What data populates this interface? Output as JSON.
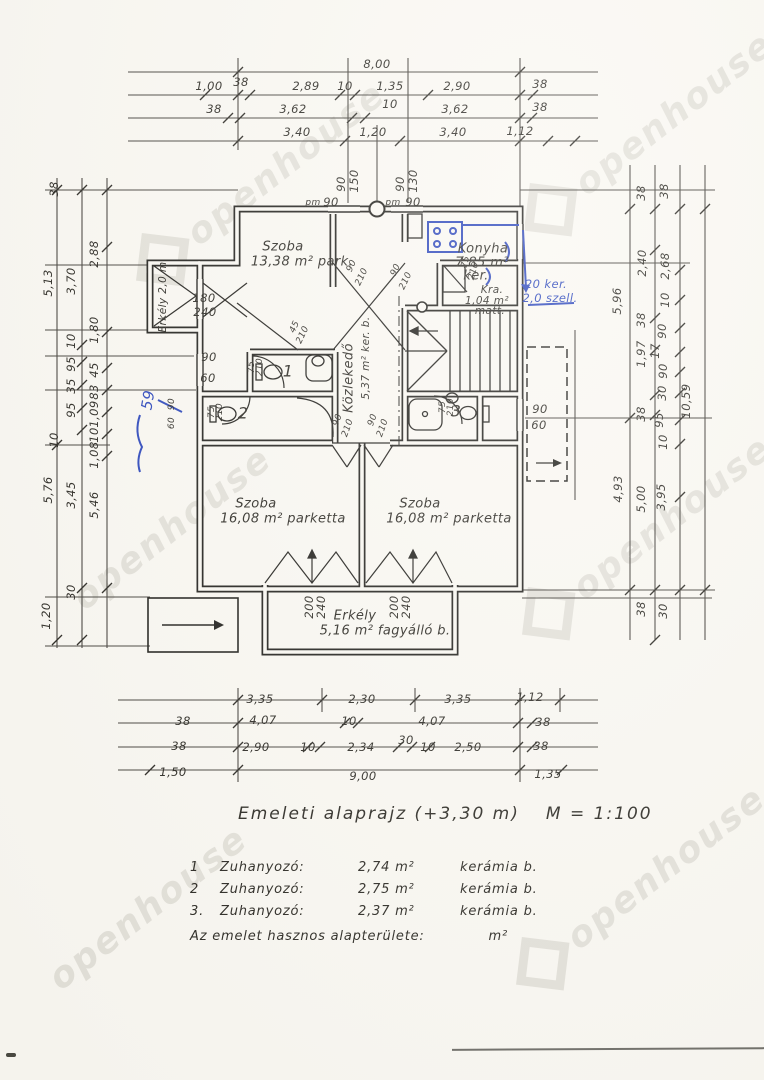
{
  "caption": {
    "text": "Emeleti alaprajz (+3,30 m)",
    "scale": "M = 1:100"
  },
  "notes": {
    "rows": [
      {
        "num": "1",
        "name": "Zuhanyozó:",
        "area": "2,74 m²",
        "finish": "kerámia b."
      },
      {
        "num": "2",
        "name": "Zuhanyozó:",
        "area": "2,75 m²",
        "finish": "kerámia b."
      },
      {
        "num": "3.",
        "name": "Zuhanyozó:",
        "area": "2,37 m²",
        "finish": "kerámia b."
      }
    ],
    "footer": {
      "text": "Az emelet hasznos alapterülete:",
      "unit": "m²"
    }
  },
  "watermark": {
    "text": "openhouse"
  },
  "colors": {
    "ink": "#2a2822",
    "blue_pen": "#2b46bb",
    "paper": "#faf8f2"
  },
  "labels": [
    {
      "t": "8,00",
      "x": 377,
      "y": 64
    },
    {
      "t": "1,00",
      "x": 209,
      "y": 86
    },
    {
      "t": "38",
      "x": 241,
      "y": 82
    },
    {
      "t": "2,89",
      "x": 306,
      "y": 86
    },
    {
      "t": "10",
      "x": 345,
      "y": 86
    },
    {
      "t": "1,35",
      "x": 390,
      "y": 86
    },
    {
      "t": "2,90",
      "x": 457,
      "y": 86
    },
    {
      "t": "38",
      "x": 540,
      "y": 84
    },
    {
      "t": "38",
      "x": 214,
      "y": 109
    },
    {
      "t": "3,62",
      "x": 293,
      "y": 109
    },
    {
      "t": "10",
      "x": 390,
      "y": 104
    },
    {
      "t": "3,62",
      "x": 455,
      "y": 109
    },
    {
      "t": "38",
      "x": 540,
      "y": 107
    },
    {
      "t": "3,40",
      "x": 297,
      "y": 132
    },
    {
      "t": "1,20",
      "x": 373,
      "y": 132
    },
    {
      "t": "3,40",
      "x": 453,
      "y": 132
    },
    {
      "t": "1,12",
      "x": 520,
      "y": 131
    },
    {
      "t": "90",
      "x": 341,
      "y": 184,
      "r": -90
    },
    {
      "t": "150",
      "x": 354,
      "y": 181,
      "r": -90
    },
    {
      "t": "90",
      "x": 400,
      "y": 184,
      "r": -90
    },
    {
      "t": "130",
      "x": 413,
      "y": 181,
      "r": -90
    },
    {
      "t": "pm",
      "x": 313,
      "y": 203,
      "s": 9
    },
    {
      "t": "90",
      "x": 331,
      "y": 202
    },
    {
      "t": "pm",
      "x": 393,
      "y": 203,
      "s": 9
    },
    {
      "t": "90",
      "x": 413,
      "y": 202
    },
    {
      "t": "38",
      "x": 54,
      "y": 189,
      "r": -90
    },
    {
      "t": "5,13",
      "x": 48,
      "y": 283,
      "r": -90
    },
    {
      "t": "3,70",
      "x": 71,
      "y": 281,
      "r": -90
    },
    {
      "t": "2,88",
      "x": 94,
      "y": 254,
      "r": -90
    },
    {
      "t": "1,80",
      "x": 94,
      "y": 330,
      "r": -90
    },
    {
      "t": "10",
      "x": 71,
      "y": 341,
      "r": -90
    },
    {
      "t": "95",
      "x": 71,
      "y": 364,
      "r": -90
    },
    {
      "t": "35",
      "x": 71,
      "y": 386,
      "r": -90
    },
    {
      "t": "95",
      "x": 71,
      "y": 410,
      "r": -90
    },
    {
      "t": "10",
      "x": 54,
      "y": 440,
      "r": -90
    },
    {
      "t": "45",
      "x": 94,
      "y": 370,
      "r": -90
    },
    {
      "t": "83",
      "x": 94,
      "y": 392,
      "r": -90
    },
    {
      "t": "1,09",
      "x": 94,
      "y": 414,
      "r": -90
    },
    {
      "t": "10",
      "x": 94,
      "y": 435,
      "r": -90
    },
    {
      "t": "1,08",
      "x": 94,
      "y": 455,
      "r": -90
    },
    {
      "t": "5,76",
      "x": 48,
      "y": 490,
      "r": -90
    },
    {
      "t": "3,45",
      "x": 71,
      "y": 495,
      "r": -90
    },
    {
      "t": "5,46",
      "x": 94,
      "y": 505,
      "r": -90
    },
    {
      "t": "30",
      "x": 71,
      "y": 592,
      "r": -90
    },
    {
      "t": "1,20",
      "x": 46,
      "y": 616,
      "r": -90
    },
    {
      "t": "38",
      "x": 641,
      "y": 193,
      "r": -90
    },
    {
      "t": "38",
      "x": 664,
      "y": 191,
      "r": -90
    },
    {
      "t": "2,40",
      "x": 642,
      "y": 263,
      "r": -90
    },
    {
      "t": "2,68",
      "x": 665,
      "y": 266,
      "r": -90
    },
    {
      "t": "10",
      "x": 665,
      "y": 300,
      "r": -90
    },
    {
      "t": "5,96",
      "x": 617,
      "y": 301,
      "r": -90
    },
    {
      "t": "38",
      "x": 641,
      "y": 320,
      "r": -90
    },
    {
      "t": "90",
      "x": 662,
      "y": 331,
      "r": -90
    },
    {
      "t": "1,97",
      "x": 641,
      "y": 354,
      "r": -90
    },
    {
      "t": "17",
      "x": 655,
      "y": 351,
      "r": -90
    },
    {
      "t": "90",
      "x": 663,
      "y": 371,
      "r": -90
    },
    {
      "t": "30",
      "x": 662,
      "y": 393,
      "r": -90
    },
    {
      "t": "10,59",
      "x": 686,
      "y": 401,
      "r": -90
    },
    {
      "t": "38",
      "x": 641,
      "y": 414,
      "r": -90
    },
    {
      "t": "95",
      "x": 659,
      "y": 420,
      "r": -90
    },
    {
      "t": "10",
      "x": 663,
      "y": 442,
      "r": -90
    },
    {
      "t": "4,93",
      "x": 618,
      "y": 489,
      "r": -90
    },
    {
      "t": "5,00",
      "x": 641,
      "y": 499,
      "r": -90
    },
    {
      "t": "3,95",
      "x": 661,
      "y": 497,
      "r": -90
    },
    {
      "t": "38",
      "x": 641,
      "y": 609,
      "r": -90
    },
    {
      "t": "30",
      "x": 663,
      "y": 611,
      "r": -90
    },
    {
      "t": "3,35",
      "x": 260,
      "y": 699
    },
    {
      "t": "2,30",
      "x": 362,
      "y": 699
    },
    {
      "t": "3,35",
      "x": 458,
      "y": 699
    },
    {
      "t": "1,12",
      "x": 530,
      "y": 697
    },
    {
      "t": "38",
      "x": 183,
      "y": 721
    },
    {
      "t": "4,07",
      "x": 263,
      "y": 720
    },
    {
      "t": "10",
      "x": 349,
      "y": 721
    },
    {
      "t": "4,07",
      "x": 432,
      "y": 721
    },
    {
      "t": "38",
      "x": 543,
      "y": 722
    },
    {
      "t": "38",
      "x": 179,
      "y": 746
    },
    {
      "t": "2,90",
      "x": 256,
      "y": 747
    },
    {
      "t": "10",
      "x": 308,
      "y": 747
    },
    {
      "t": "2,34",
      "x": 361,
      "y": 747
    },
    {
      "t": "30",
      "x": 406,
      "y": 740
    },
    {
      "t": "10",
      "x": 428,
      "y": 747
    },
    {
      "t": "2,50",
      "x": 468,
      "y": 747
    },
    {
      "t": "38",
      "x": 541,
      "y": 746
    },
    {
      "t": "1,50",
      "x": 173,
      "y": 772
    },
    {
      "t": "9,00",
      "x": 363,
      "y": 776
    },
    {
      "t": "1,35",
      "x": 548,
      "y": 774
    },
    {
      "t": "Szoba",
      "x": 283,
      "y": 247,
      "cls": "room",
      "n": "room-label-szoba-1"
    },
    {
      "t": "13,38 m² park.",
      "x": 302,
      "y": 262,
      "cls": "room"
    },
    {
      "t": "Konyha",
      "x": 483,
      "y": 249,
      "cls": "room",
      "n": "room-label-konyha"
    },
    {
      "t": "7,85 m²",
      "x": 482,
      "y": 263,
      "cls": "room"
    },
    {
      "t": "ker.",
      "x": 476,
      "y": 276,
      "cls": "room"
    },
    {
      "t": "Kra.",
      "x": 492,
      "y": 290,
      "cls": "rsmall",
      "n": "room-label-kamra"
    },
    {
      "t": "1,04 m²",
      "x": 487,
      "y": 301,
      "cls": "rsmall"
    },
    {
      "t": "matt.",
      "x": 490,
      "y": 311,
      "cls": "rsmall"
    },
    {
      "t": "Közlekedő",
      "x": 349,
      "y": 378,
      "r": -90,
      "cls": "room",
      "n": "room-label-kozlekedo"
    },
    {
      "t": "5,37 m² ker. b.",
      "x": 366,
      "y": 358,
      "r": -90,
      "cls": "rsmall"
    },
    {
      "t": "1",
      "x": 288,
      "y": 371,
      "cls": "num",
      "n": "bath-number-1"
    },
    {
      "t": "2",
      "x": 243,
      "y": 413,
      "cls": "num",
      "n": "bath-number-2"
    },
    {
      "t": "3",
      "x": 456,
      "y": 411,
      "cls": "num",
      "n": "bath-number-3"
    },
    {
      "t": "Szoba",
      "x": 256,
      "y": 504,
      "cls": "room",
      "n": "room-label-szoba-2"
    },
    {
      "t": "16,08 m² parketta",
      "x": 283,
      "y": 519,
      "cls": "room"
    },
    {
      "t": "Szoba",
      "x": 420,
      "y": 504,
      "cls": "room",
      "n": "room-label-szoba-3"
    },
    {
      "t": "16,08 m² parketta",
      "x": 449,
      "y": 519,
      "cls": "room"
    },
    {
      "t": "Erkély",
      "x": 355,
      "y": 616,
      "cls": "room",
      "n": "room-label-erkely"
    },
    {
      "t": "5,16 m² fagyálló b.",
      "x": 385,
      "y": 631,
      "cls": "room"
    },
    {
      "t": "Erkély 2,0 m",
      "x": 163,
      "y": 297,
      "r": -90,
      "cls": "rsmall",
      "n": "room-label-erkely-left"
    },
    {
      "t": "180",
      "x": 204,
      "y": 298
    },
    {
      "t": "240",
      "x": 205,
      "y": 312
    },
    {
      "t": "200",
      "x": 309,
      "y": 607,
      "r": -90
    },
    {
      "t": "240",
      "x": 321,
      "y": 607,
      "r": -90
    },
    {
      "t": "200",
      "x": 394,
      "y": 607,
      "r": -90
    },
    {
      "t": "240",
      "x": 406,
      "y": 607,
      "r": -90
    },
    {
      "t": "90",
      "x": 209,
      "y": 357
    },
    {
      "t": "60",
      "x": 208,
      "y": 378
    },
    {
      "t": "90",
      "x": 172,
      "y": 404,
      "r": -90,
      "s": 9
    },
    {
      "t": "60",
      "x": 172,
      "y": 423,
      "r": -90,
      "s": 9
    },
    {
      "t": "90",
      "x": 540,
      "y": 409
    },
    {
      "t": "60",
      "x": 539,
      "y": 425
    },
    {
      "t": "90",
      "x": 352,
      "y": 266,
      "r": -65,
      "s": 9
    },
    {
      "t": "210",
      "x": 362,
      "y": 277,
      "r": -65,
      "s": 9
    },
    {
      "t": "90",
      "x": 396,
      "y": 270,
      "r": -65,
      "s": 9
    },
    {
      "t": "210",
      "x": 406,
      "y": 281,
      "r": -65,
      "s": 9
    },
    {
      "t": "90",
      "x": 338,
      "y": 420,
      "r": -70,
      "s": 9
    },
    {
      "t": "210",
      "x": 348,
      "y": 428,
      "r": -70,
      "s": 9
    },
    {
      "t": "90",
      "x": 373,
      "y": 420,
      "r": -70,
      "s": 9
    },
    {
      "t": "210",
      "x": 383,
      "y": 428,
      "r": -70,
      "s": 9
    },
    {
      "t": "75",
      "x": 252,
      "y": 367,
      "r": -90,
      "s": 9
    },
    {
      "t": "210",
      "x": 260,
      "y": 367,
      "r": -90,
      "s": 9
    },
    {
      "t": "75",
      "x": 212,
      "y": 412,
      "r": -90,
      "s": 9
    },
    {
      "t": "210",
      "x": 220,
      "y": 412,
      "r": -90,
      "s": 9
    },
    {
      "t": "75",
      "x": 443,
      "y": 407,
      "r": -90,
      "s": 9
    },
    {
      "t": "210",
      "x": 451,
      "y": 407,
      "r": -90,
      "s": 9
    },
    {
      "t": "75",
      "x": 466,
      "y": 262,
      "r": -75,
      "s": 9
    },
    {
      "t": "210",
      "x": 474,
      "y": 271,
      "r": -75,
      "s": 9
    },
    {
      "t": "45",
      "x": 295,
      "y": 327,
      "r": -65,
      "s": 9
    },
    {
      "t": "210",
      "x": 303,
      "y": 335,
      "r": -65,
      "s": 9
    },
    {
      "t": "20 ker.",
      "x": 546,
      "y": 284,
      "cls": "blue",
      "n": "blue-note-ker"
    },
    {
      "t": "2,0 szell.",
      "x": 550,
      "y": 298,
      "cls": "blue",
      "n": "blue-note-szell"
    },
    {
      "t": "59",
      "x": 148,
      "y": 400,
      "r": -80,
      "cls": "blue",
      "s": 15,
      "n": "blue-note-59"
    }
  ]
}
